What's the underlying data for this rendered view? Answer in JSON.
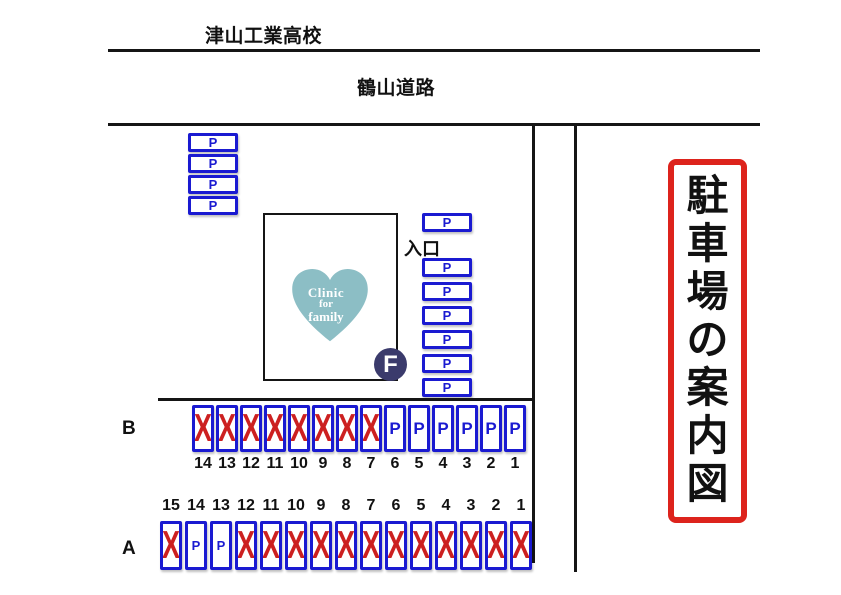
{
  "labels": {
    "school": "津山工業高校",
    "road": "鶴山道路",
    "entrance": "入口",
    "sign_title": "駐車場の案内図"
  },
  "clinic": {
    "name_line1": "Clinic",
    "name_line2": "for",
    "name_line3": "family",
    "logo_letter": "F"
  },
  "symbols": {
    "parking": "P",
    "occupied": "X"
  },
  "colors": {
    "stall_blue": "#1a1ad1",
    "occupied_red": "#cc2020",
    "sign_border_red": "#dd231c",
    "heart_teal": "#8cbec5",
    "logo_navy": "#3b3b6c",
    "line_black": "#151515"
  },
  "street_parking": {
    "left_column": [
      "P",
      "P",
      "P",
      "P"
    ],
    "right_column_top": [
      "P"
    ],
    "right_column": [
      "P",
      "P",
      "P",
      "P",
      "P",
      "P"
    ]
  },
  "row_b": {
    "label": "B",
    "stalls": [
      {
        "number": "14",
        "status": "occupied"
      },
      {
        "number": "13",
        "status": "occupied"
      },
      {
        "number": "12",
        "status": "occupied"
      },
      {
        "number": "11",
        "status": "occupied"
      },
      {
        "number": "10",
        "status": "occupied"
      },
      {
        "number": "9",
        "status": "occupied"
      },
      {
        "number": "8",
        "status": "occupied"
      },
      {
        "number": "7",
        "status": "occupied"
      },
      {
        "number": "6",
        "status": "available"
      },
      {
        "number": "5",
        "status": "available"
      },
      {
        "number": "4",
        "status": "available"
      },
      {
        "number": "3",
        "status": "available"
      },
      {
        "number": "2",
        "status": "available"
      },
      {
        "number": "1",
        "status": "available"
      }
    ]
  },
  "row_a": {
    "label": "A",
    "stalls": [
      {
        "number": "15",
        "status": "occupied"
      },
      {
        "number": "14",
        "status": "available"
      },
      {
        "number": "13",
        "status": "available"
      },
      {
        "number": "12",
        "status": "occupied"
      },
      {
        "number": "11",
        "status": "occupied"
      },
      {
        "number": "10",
        "status": "occupied"
      },
      {
        "number": "9",
        "status": "occupied"
      },
      {
        "number": "8",
        "status": "occupied"
      },
      {
        "number": "7",
        "status": "occupied"
      },
      {
        "number": "6",
        "status": "occupied"
      },
      {
        "number": "5",
        "status": "occupied"
      },
      {
        "number": "4",
        "status": "occupied"
      },
      {
        "number": "3",
        "status": "occupied"
      },
      {
        "number": "2",
        "status": "occupied"
      },
      {
        "number": "1",
        "status": "occupied"
      }
    ]
  }
}
